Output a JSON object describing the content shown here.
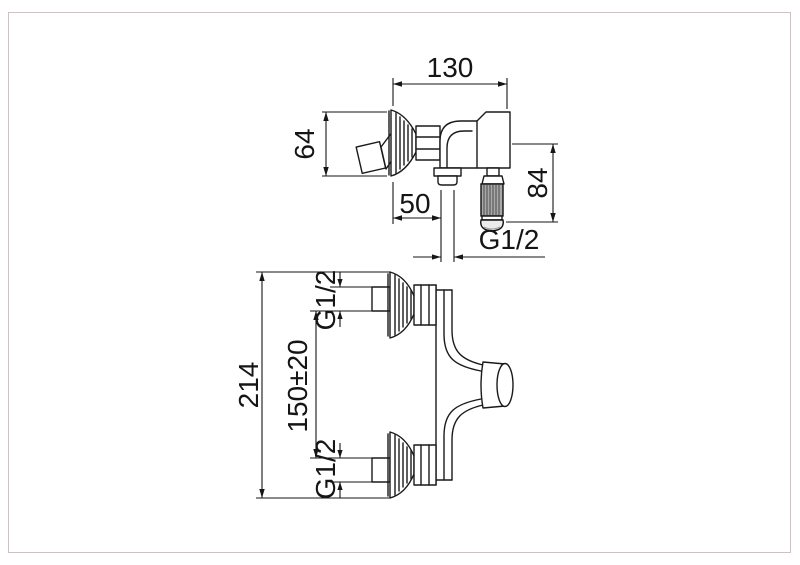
{
  "side_view": {
    "width": "130",
    "flange_diameter": "64",
    "wall_to_outlet": "50",
    "handle_drop": "84",
    "outlet_thread": "G1/2"
  },
  "front_view": {
    "overall_height": "214",
    "inlet_spacing": "150±20",
    "inlet_thread_top": "G1/2",
    "inlet_thread_bottom": "G1/2"
  },
  "colors": {
    "line": "#1a1a1a",
    "page_border": "#ccc2c2",
    "handle_grip_fill": "#a8a8a8"
  }
}
